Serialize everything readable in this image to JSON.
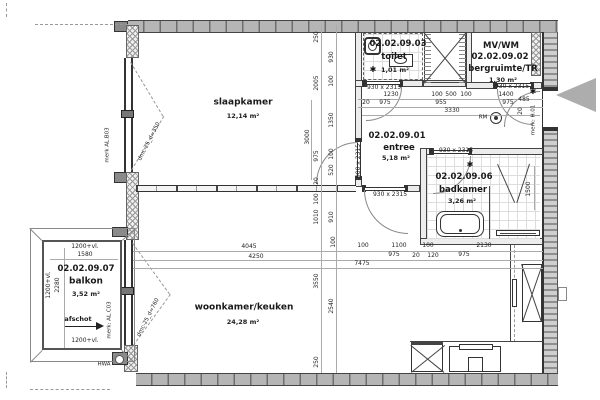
{
  "rooms": {
    "slaapkamer": {
      "name": "slaapkamer",
      "area": "12,14 m²"
    },
    "toilet": {
      "number": "02.02.09.03",
      "name": "toilet",
      "area": "1,01 m²"
    },
    "bergruimte": {
      "label1": "MV/WM",
      "number": "02.02.09.02",
      "name": "bergruimte/TR",
      "area": "1,30 m²"
    },
    "entree": {
      "number": "02.02.09.01",
      "name": "entree",
      "area": "5,18 m²"
    },
    "badkamer": {
      "number": "02.02.09.06",
      "name": "badkamer",
      "area": "3,26 m²"
    },
    "woonkamer": {
      "name": "woonkamer/keuken",
      "area": "24,28 m²"
    },
    "balkon": {
      "number": "02.02.09.07",
      "name": "balkon",
      "area": "3,52 m²"
    }
  },
  "labels": [
    {
      "t": "250",
      "x": 317,
      "y": 37,
      "r": -90
    },
    {
      "t": "2005",
      "x": 317,
      "y": 83,
      "r": -90
    },
    {
      "t": "3000",
      "x": 308,
      "y": 137,
      "r": -90
    },
    {
      "t": "930",
      "x": 332,
      "y": 57,
      "r": -90
    },
    {
      "t": "100",
      "x": 332,
      "y": 81,
      "r": -90
    },
    {
      "t": "1350",
      "x": 332,
      "y": 120,
      "r": -90
    },
    {
      "t": "975",
      "x": 317,
      "y": 156,
      "r": -90
    },
    {
      "t": "20",
      "x": 317,
      "y": 181,
      "r": -90
    },
    {
      "t": "100",
      "x": 332,
      "y": 154,
      "r": -90
    },
    {
      "t": "520",
      "x": 332,
      "y": 170,
      "r": -90
    },
    {
      "t": "100",
      "x": 317,
      "y": 199,
      "r": -90
    },
    {
      "t": "1010",
      "x": 317,
      "y": 217,
      "r": -90
    },
    {
      "t": "910",
      "x": 332,
      "y": 217,
      "r": -90
    },
    {
      "t": "100",
      "x": 334,
      "y": 242,
      "r": -90
    },
    {
      "t": "3550",
      "x": 317,
      "y": 281,
      "r": -90
    },
    {
      "t": "2540",
      "x": 332,
      "y": 306,
      "r": -90
    },
    {
      "t": "250",
      "x": 317,
      "y": 362,
      "r": -90
    },
    {
      "t": "1230",
      "x": 391,
      "y": 95
    },
    {
      "t": "100",
      "x": 437,
      "y": 95
    },
    {
      "t": "500",
      "x": 451,
      "y": 95
    },
    {
      "t": "100",
      "x": 466,
      "y": 95
    },
    {
      "t": "1400",
      "x": 506,
      "y": 95
    },
    {
      "t": "20",
      "x": 366,
      "y": 103
    },
    {
      "t": "975",
      "x": 385,
      "y": 103
    },
    {
      "t": "955",
      "x": 441,
      "y": 103
    },
    {
      "t": "975",
      "x": 508,
      "y": 103
    },
    {
      "t": "485",
      "x": 524,
      "y": 100
    },
    {
      "t": "20",
      "x": 521,
      "y": 111,
      "r": -90
    },
    {
      "t": "3330",
      "x": 452,
      "y": 111
    },
    {
      "t": "100",
      "x": 363,
      "y": 246
    },
    {
      "t": "1100",
      "x": 399,
      "y": 246
    },
    {
      "t": "100",
      "x": 428,
      "y": 246
    },
    {
      "t": "2130",
      "x": 484,
      "y": 246
    },
    {
      "t": "975",
      "x": 394,
      "y": 255
    },
    {
      "t": "20",
      "x": 416,
      "y": 256
    },
    {
      "t": "120",
      "x": 433,
      "y": 256
    },
    {
      "t": "975",
      "x": 464,
      "y": 255
    },
    {
      "t": "7475",
      "x": 362,
      "y": 264
    },
    {
      "t": "4045",
      "x": 249,
      "y": 247
    },
    {
      "t": "4250",
      "x": 256,
      "y": 257
    },
    {
      "t": "1500",
      "x": 529,
      "y": 189,
      "r": -90
    },
    {
      "t": "1200+vl.",
      "x": 85,
      "y": 247
    },
    {
      "t": "1580",
      "x": 85,
      "y": 255
    },
    {
      "t": "1200+vl.",
      "x": 49,
      "y": 285,
      "r": -90
    },
    {
      "t": "2280",
      "x": 58,
      "y": 285,
      "r": -90
    },
    {
      "t": "1200+vl.",
      "x": 85,
      "y": 341
    },
    {
      "t": "930 x 2315",
      "x": 384,
      "y": 88,
      "c": "door"
    },
    {
      "t": "930 x 2315",
      "x": 512,
      "y": 87,
      "c": "door"
    },
    {
      "t": "930 x 2315",
      "x": 456,
      "y": 151,
      "c": "door"
    },
    {
      "t": "930 x 2315",
      "x": 390,
      "y": 195,
      "c": "door"
    },
    {
      "t": "900 x 2315",
      "x": 359,
      "y": 161,
      "r": -90,
      "c": "door"
    },
    {
      "t": "merk AL.B03",
      "x": 108,
      "y": 145,
      "r": -90,
      "c": "mark"
    },
    {
      "t": "dmc-25_d=350",
      "x": 150,
      "y": 142,
      "r": -63,
      "c": "mark"
    },
    {
      "t": "dmc-25_d=760",
      "x": 149,
      "y": 318,
      "r": -63,
      "c": "mark"
    },
    {
      "t": "merk: AL.C03",
      "x": 110,
      "y": 320,
      "r": -90,
      "c": "mark"
    },
    {
      "t": "merk: H.01",
      "x": 534,
      "y": 120,
      "r": -90,
      "c": "mark"
    },
    {
      "t": "afschot",
      "x": 78,
      "y": 319,
      "c": "ann"
    },
    {
      "t": "HWA",
      "x": 104,
      "y": 365,
      "c": "mark"
    },
    {
      "t": "RM",
      "x": 483,
      "y": 118,
      "c": "mark"
    },
    {
      "t": "✱",
      "x": 373,
      "y": 70,
      "c": "star"
    },
    {
      "t": "✱",
      "x": 533,
      "y": 92,
      "c": "star"
    },
    {
      "t": "✱",
      "x": 470,
      "y": 165,
      "c": "star"
    }
  ]
}
